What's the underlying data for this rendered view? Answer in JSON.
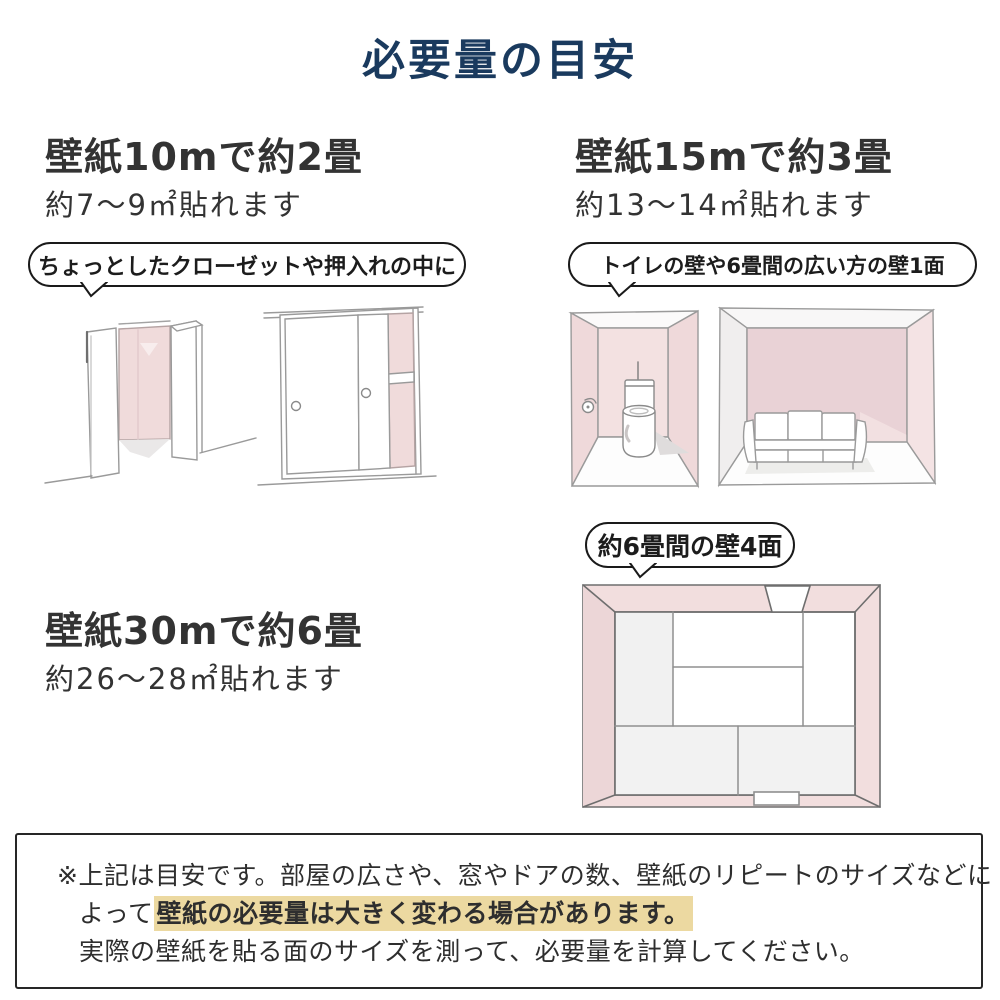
{
  "title": "必要量の目安",
  "colors": {
    "title_navy": "#1a3a5e",
    "text_dark": "#333333",
    "bubble_border": "#1a1a1a",
    "wall_pink": "#f2dede",
    "highlight_tan": "#ecd9a1",
    "sketch_line_gray": "#9a9a9a"
  },
  "sections": [
    {
      "headline": "壁紙10mで約2畳",
      "subline": "約7〜9㎡貼れます",
      "bubble": "ちょっとしたクローゼットや押入れの中に",
      "illustrations": [
        "open-closet",
        "sliding-door-closet"
      ]
    },
    {
      "headline": "壁紙15mで約3畳",
      "subline": "約13〜14㎡貼れます",
      "bubble": "トイレの壁や6畳間の広い方の壁1面",
      "illustrations": [
        "toilet-room",
        "six-mat-room-wide-wall"
      ]
    },
    {
      "headline": "壁紙30mで約6畳",
      "subline": "約26〜28㎡貼れます",
      "bubble": "約6畳間の壁4面",
      "illustrations": [
        "six-mat-room-top-view"
      ]
    }
  ],
  "note": {
    "line1": "※上記は目安です。部屋の広さや、窓やドアの数、壁紙のリピートのサイズなどに",
    "line2_before": "よって",
    "line2_highlight": "壁紙の必要量は大きく変わる場合があります。",
    "line3": "実際の壁紙を貼る面のサイズを測って、必要量を計算してください。"
  }
}
